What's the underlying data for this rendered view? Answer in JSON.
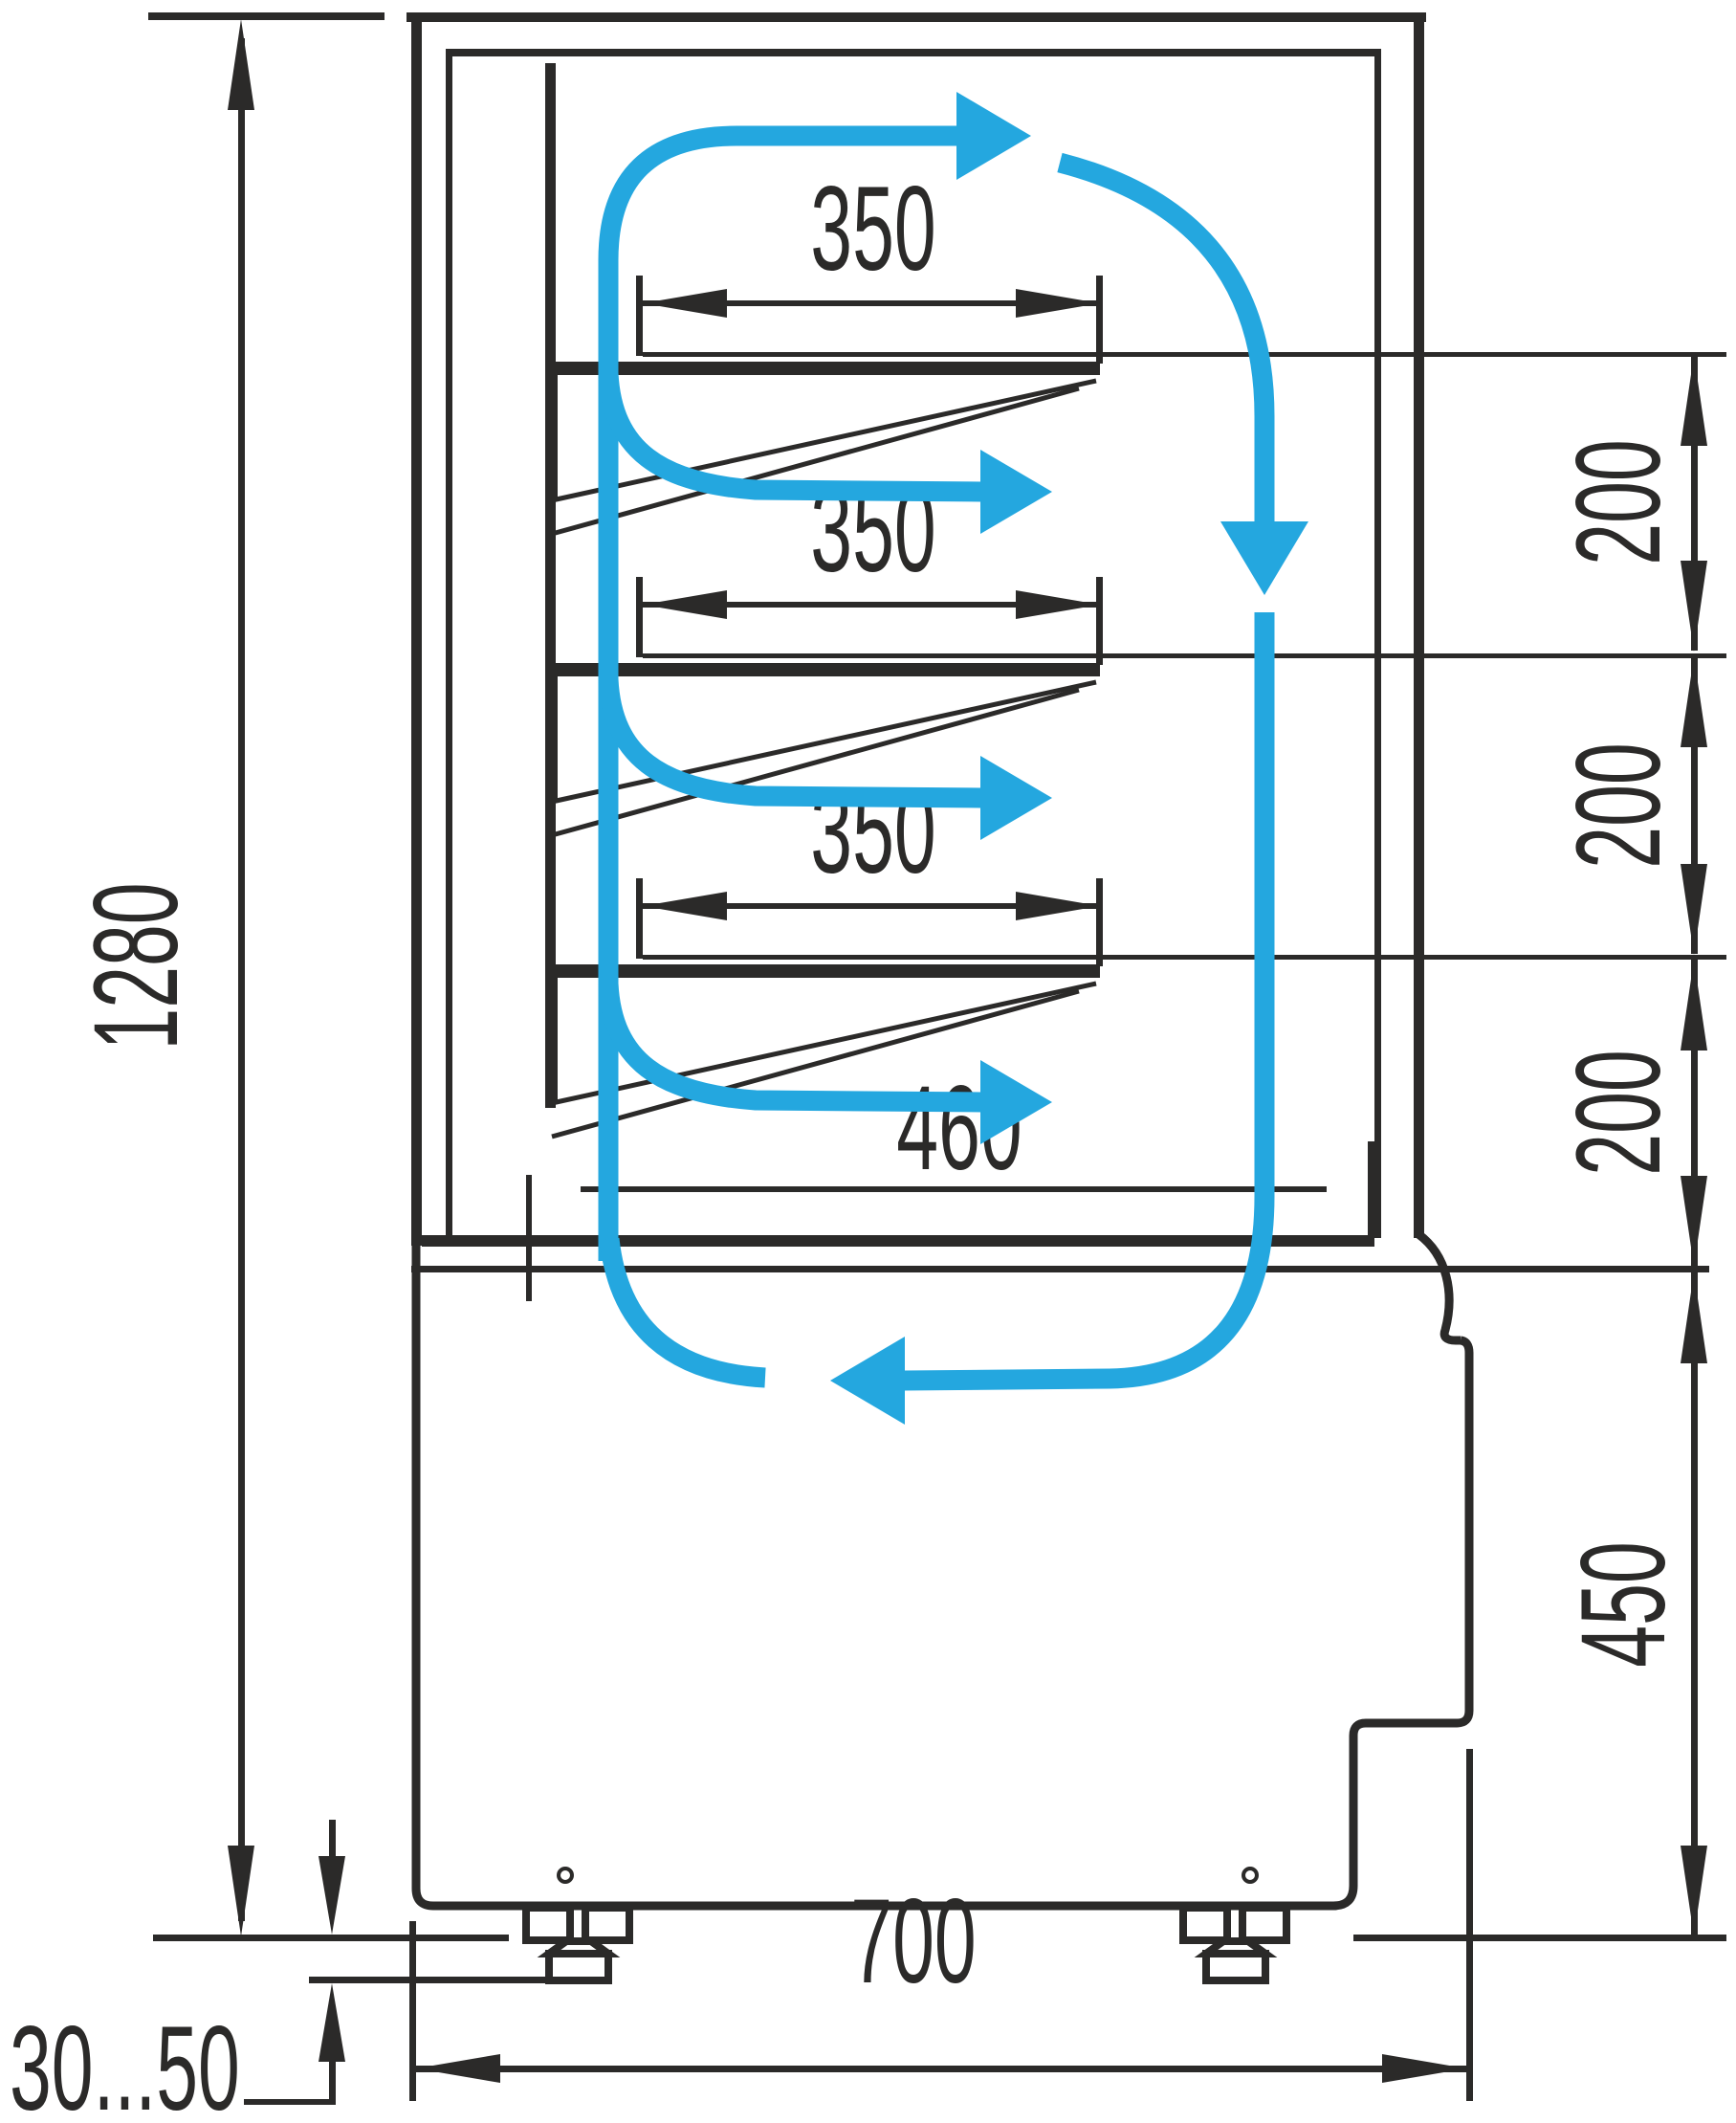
{
  "diagram": {
    "kind": "refrigerated-display-case-side-section",
    "dims": {
      "overall_height": "1280",
      "shelf_depth_top": "350",
      "shelf_depth_middle": "350",
      "shelf_depth_lower": "350",
      "bottom_shelf_depth": "460",
      "shelf_gap_top": "200",
      "shelf_gap_middle": "200",
      "shelf_gap_bottom": "200",
      "base_height": "450",
      "overall_depth": "700",
      "leg_adjust_range": "30...50"
    },
    "colors": {
      "line": "#2b2a29",
      "airflow": "#24a7df",
      "background": "#ffffff"
    }
  }
}
